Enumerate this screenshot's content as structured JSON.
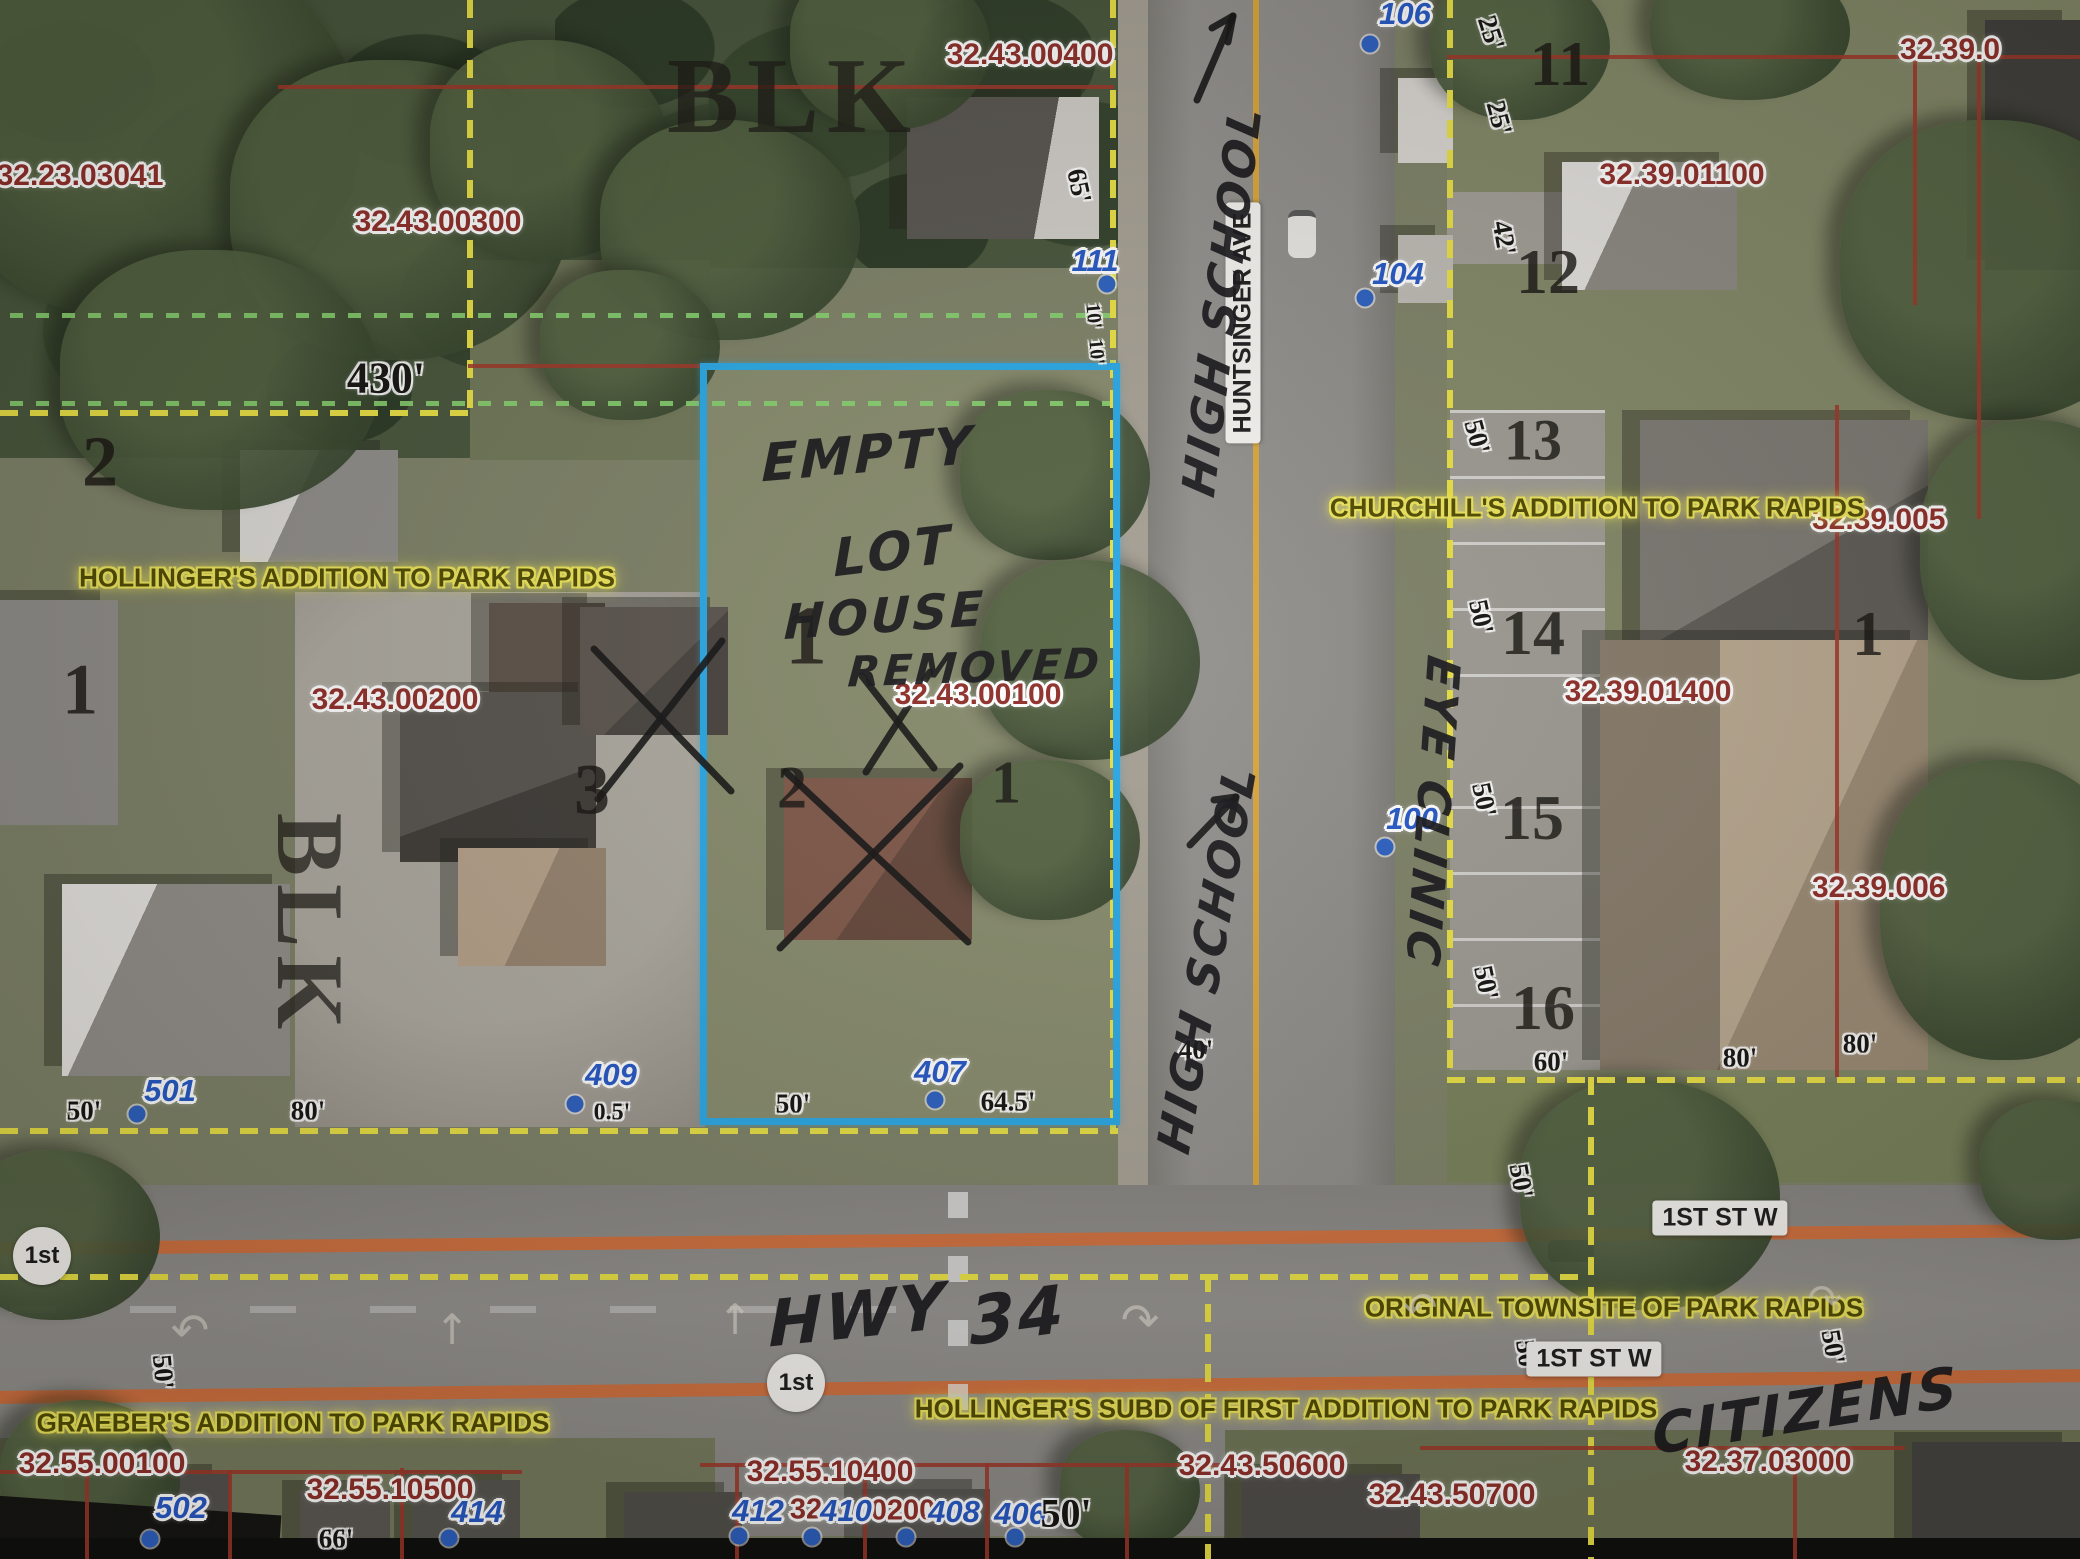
{
  "canvas": {
    "w": 2080,
    "h": 1559
  },
  "colors": {
    "highlight_blue": "#28a7e4",
    "parcel_red": "#8f2d28",
    "house_blue": "#2457c5",
    "boundary_yellow": "#e9e043",
    "setback_green": "#86d36e",
    "section_red": "#9e3527",
    "road_edge_orange": "#cf6f3e",
    "subdivision_yellow": "#f4ec55"
  },
  "highlight_box": {
    "x": 700,
    "y": 363,
    "w": 420,
    "h": 762
  },
  "labels": [
    {
      "t": "parcel",
      "s": "32.23.03041",
      "x": 80,
      "y": 176
    },
    {
      "t": "parcel",
      "s": "32.43.00300",
      "x": 438,
      "y": 222
    },
    {
      "t": "parcel",
      "s": "32.43.00400",
      "x": 1030,
      "y": 55
    },
    {
      "t": "parcel",
      "s": "32.43.00200",
      "x": 395,
      "y": 700
    },
    {
      "t": "parcel",
      "s": "32.43.00100",
      "x": 978,
      "y": 695
    },
    {
      "t": "parcel",
      "s": "32.39.01100",
      "x": 1682,
      "y": 175
    },
    {
      "t": "parcel",
      "s": "32.39.0",
      "x": 1900,
      "y": 50,
      "a": "l"
    },
    {
      "t": "parcel",
      "s": "32.39.005",
      "x": 1812,
      "y": 520,
      "a": "l"
    },
    {
      "t": "parcel",
      "s": "32.39.006",
      "x": 1812,
      "y": 888,
      "a": "l"
    },
    {
      "t": "parcel",
      "s": "32.39.01400",
      "x": 1648,
      "y": 692
    },
    {
      "t": "parcel",
      "s": "32.55.00100",
      "x": 102,
      "y": 1464
    },
    {
      "t": "parcel",
      "s": "32.55.10400",
      "x": 830,
      "y": 1472
    },
    {
      "t": "parcel",
      "s": "32.55.10500",
      "x": 390,
      "y": 1490
    },
    {
      "t": "parcel",
      "s": "32.43.50600",
      "x": 1262,
      "y": 1466
    },
    {
      "t": "parcel",
      "s": "32.43.50700",
      "x": 1452,
      "y": 1495
    },
    {
      "t": "parcel",
      "s": "32.37.03000",
      "x": 1768,
      "y": 1462
    },
    {
      "t": "parcel",
      "s": "32",
      "x": 806,
      "y": 1510,
      "z": 29
    },
    {
      "t": "parcel",
      "s": "0200",
      "x": 903,
      "y": 1511,
      "z": 29
    },
    {
      "t": "house",
      "s": "111",
      "x": 1095,
      "y": 261
    },
    {
      "t": "house",
      "s": "106",
      "x": 1405,
      "y": 14
    },
    {
      "t": "house",
      "s": "104",
      "x": 1398,
      "y": 274
    },
    {
      "t": "house",
      "s": "100",
      "x": 1412,
      "y": 819
    },
    {
      "t": "house",
      "s": "501",
      "x": 170,
      "y": 1091
    },
    {
      "t": "house",
      "s": "409",
      "x": 611,
      "y": 1075
    },
    {
      "t": "house",
      "s": "407",
      "x": 940,
      "y": 1072
    },
    {
      "t": "house",
      "s": "502",
      "x": 181,
      "y": 1508
    },
    {
      "t": "house",
      "s": "414",
      "x": 477,
      "y": 1512
    },
    {
      "t": "house",
      "s": "412",
      "x": 758,
      "y": 1511
    },
    {
      "t": "house",
      "s": "410",
      "x": 846,
      "y": 1511
    },
    {
      "t": "house",
      "s": "408",
      "x": 954,
      "y": 1512
    },
    {
      "t": "house",
      "s": "406",
      "x": 1020,
      "y": 1514
    },
    {
      "t": "lot",
      "s": "2",
      "x": 100,
      "y": 462,
      "z": 72
    },
    {
      "t": "lot",
      "s": "1",
      "x": 80,
      "y": 690,
      "z": 72
    },
    {
      "t": "lot",
      "s": "3",
      "x": 592,
      "y": 790,
      "z": 72
    },
    {
      "t": "lot",
      "s": "2",
      "x": 792,
      "y": 788,
      "z": 60
    },
    {
      "t": "lot",
      "s": "1",
      "x": 1006,
      "y": 783,
      "z": 60
    },
    {
      "t": "lot",
      "s": "1",
      "x": 806,
      "y": 636,
      "z": 84
    },
    {
      "t": "lot",
      "s": "11",
      "x": 1560,
      "y": 64,
      "z": 64
    },
    {
      "t": "lot",
      "s": "12",
      "x": 1548,
      "y": 272,
      "z": 64
    },
    {
      "t": "lot",
      "s": "13",
      "x": 1533,
      "y": 440,
      "z": 58
    },
    {
      "t": "lot",
      "s": "14",
      "x": 1533,
      "y": 633,
      "z": 64
    },
    {
      "t": "lot",
      "s": "15",
      "x": 1532,
      "y": 818,
      "z": 64
    },
    {
      "t": "lot",
      "s": "16",
      "x": 1543,
      "y": 1008,
      "z": 64
    },
    {
      "t": "lot",
      "s": "1",
      "x": 1868,
      "y": 634,
      "z": 64
    },
    {
      "t": "blk",
      "s": "BLK",
      "x": 793,
      "y": 97,
      "z": 108
    },
    {
      "t": "blk",
      "s": "BLK",
      "x": 310,
      "y": 925,
      "z": 95,
      "r": 90
    },
    {
      "t": "dim",
      "s": "430'",
      "x": 386,
      "y": 378,
      "z": 44
    },
    {
      "t": "dim",
      "s": "65'",
      "x": 1079,
      "y": 186,
      "r": 78
    },
    {
      "t": "dim",
      "s": "25'",
      "x": 1491,
      "y": 33,
      "r": 72
    },
    {
      "t": "dim",
      "s": "25'",
      "x": 1499,
      "y": 118,
      "r": 75
    },
    {
      "t": "dim",
      "s": "42'",
      "x": 1504,
      "y": 238,
      "r": 80
    },
    {
      "t": "dim",
      "s": "10'",
      "x": 1093,
      "y": 316,
      "r": 85,
      "z": 20
    },
    {
      "t": "dim",
      "s": "10'",
      "x": 1096,
      "y": 352,
      "r": 85,
      "z": 20
    },
    {
      "t": "dim",
      "s": "50'",
      "x": 84,
      "y": 1111
    },
    {
      "t": "dim",
      "s": "80'",
      "x": 308,
      "y": 1111
    },
    {
      "t": "dim",
      "s": "0.5'",
      "x": 612,
      "y": 1113,
      "z": 24
    },
    {
      "t": "dim",
      "s": "50'",
      "x": 793,
      "y": 1104
    },
    {
      "t": "dim",
      "s": "64.5'",
      "x": 1008,
      "y": 1102
    },
    {
      "t": "dim",
      "s": "40'",
      "x": 1196,
      "y": 1050
    },
    {
      "t": "dim",
      "s": "50'",
      "x": 1477,
      "y": 437,
      "r": 75
    },
    {
      "t": "dim",
      "s": "50'",
      "x": 1481,
      "y": 617,
      "r": 78
    },
    {
      "t": "dim",
      "s": "50'",
      "x": 1484,
      "y": 800,
      "r": 78
    },
    {
      "t": "dim",
      "s": "50'",
      "x": 1486,
      "y": 983,
      "r": 78
    },
    {
      "t": "dim",
      "s": "60'",
      "x": 1551,
      "y": 1062
    },
    {
      "t": "dim",
      "s": "80'",
      "x": 1740,
      "y": 1058
    },
    {
      "t": "dim",
      "s": "80'",
      "x": 1860,
      "y": 1044
    },
    {
      "t": "dim",
      "s": "50'",
      "x": 163,
      "y": 1372,
      "r": 85
    },
    {
      "t": "dim",
      "s": "50'",
      "x": 1521,
      "y": 1181,
      "r": 80
    },
    {
      "t": "dim",
      "s": "50'",
      "x": 1527,
      "y": 1357,
      "r": 82
    },
    {
      "t": "dim",
      "s": "50'",
      "x": 1833,
      "y": 1347,
      "r": 80
    },
    {
      "t": "dim",
      "s": "66'",
      "x": 336,
      "y": 1539
    },
    {
      "t": "dim",
      "s": "50'",
      "x": 1066,
      "y": 1513,
      "z": 40
    },
    {
      "t": "sub",
      "s": "HOLLINGER'S ADDITION TO PARK RAPIDS",
      "x": 347,
      "y": 578
    },
    {
      "t": "sub",
      "s": "CHURCHILL'S ADDITION TO PARK RAPIDS",
      "x": 1597,
      "y": 508
    },
    {
      "t": "sub",
      "s": "ORIGINAL TOWNSITE OF PARK RAPIDS",
      "x": 1614,
      "y": 1308
    },
    {
      "t": "sub",
      "s": "GRAEBER'S ADDITION TO PARK RAPIDS",
      "x": 293,
      "y": 1423
    },
    {
      "t": "sub",
      "s": "HOLLINGER'S SUBD OF FIRST ADDITION TO PARK RAPIDS",
      "x": 1286,
      "y": 1409
    },
    {
      "t": "street",
      "s": "1ST ST W",
      "x": 1720,
      "y": 1218
    },
    {
      "t": "street",
      "s": "1ST ST W",
      "x": 1594,
      "y": 1359
    },
    {
      "t": "street",
      "s": "HUNTSINGER AVE",
      "x": 1243,
      "y": 323,
      "r": -90
    },
    {
      "t": "shield",
      "s": "1st",
      "x": 42,
      "y": 1256
    },
    {
      "t": "shield",
      "s": "1st",
      "x": 796,
      "y": 1383
    },
    {
      "t": "hand",
      "s": "EMPTY",
      "x": 868,
      "y": 455,
      "z": 52,
      "r": -5
    },
    {
      "t": "hand",
      "s": "LOT",
      "x": 893,
      "y": 552,
      "z": 52,
      "r": -7
    },
    {
      "t": "hand",
      "s": "HOUSE",
      "x": 885,
      "y": 616,
      "z": 48,
      "r": -4
    },
    {
      "t": "hand",
      "s": "REMOVED",
      "x": 975,
      "y": 668,
      "z": 42,
      "r": -2
    },
    {
      "t": "hand",
      "s": "HIGH SCHOOL",
      "x": 1222,
      "y": 300,
      "z": 46,
      "r": -83
    },
    {
      "t": "hand",
      "s": "HIGH SCHOOL",
      "x": 1207,
      "y": 958,
      "z": 46,
      "r": -80
    },
    {
      "t": "hand",
      "s": "EYE CLINIC",
      "x": 1433,
      "y": 812,
      "z": 46,
      "r": 94
    },
    {
      "t": "hand",
      "s": "HWY",
      "x": 858,
      "y": 1316,
      "z": 64,
      "r": -6
    },
    {
      "t": "hand",
      "s": "34",
      "x": 1018,
      "y": 1316,
      "z": 66,
      "r": -8
    },
    {
      "t": "hand",
      "s": "CITIZENS",
      "x": 1806,
      "y": 1412,
      "z": 56,
      "r": -9
    },
    {
      "t": "rarrow",
      "s": "↶",
      "x": 190,
      "y": 1330,
      "z": 46
    },
    {
      "t": "rarrow",
      "s": "↑",
      "x": 452,
      "y": 1330,
      "z": 42
    },
    {
      "t": "rarrow",
      "s": "↑",
      "x": 735,
      "y": 1320,
      "z": 42
    },
    {
      "t": "rarrow",
      "s": "↷",
      "x": 1140,
      "y": 1320,
      "z": 46
    },
    {
      "t": "rarrow",
      "s": "↶",
      "x": 1420,
      "y": 1308,
      "z": 42
    },
    {
      "t": "rarrow",
      "s": "↷",
      "x": 1825,
      "y": 1300,
      "z": 42
    }
  ],
  "dots": [
    {
      "x": 1107,
      "y": 284
    },
    {
      "x": 1370,
      "y": 44
    },
    {
      "x": 1365,
      "y": 298
    },
    {
      "x": 1385,
      "y": 847
    },
    {
      "x": 137,
      "y": 1114
    },
    {
      "x": 575,
      "y": 1104
    },
    {
      "x": 935,
      "y": 1100
    },
    {
      "x": 150,
      "y": 1539
    },
    {
      "x": 449,
      "y": 1538
    },
    {
      "x": 739,
      "y": 1536
    },
    {
      "x": 812,
      "y": 1537
    },
    {
      "x": 906,
      "y": 1537
    },
    {
      "x": 1015,
      "y": 1537
    }
  ],
  "lines": [
    {
      "k": "y",
      "o": "v",
      "x": 467,
      "y": 0,
      "len": 412
    },
    {
      "k": "y",
      "o": "h",
      "x": 0,
      "y": 410,
      "len": 472
    },
    {
      "k": "y",
      "o": "v",
      "x": 1110,
      "y": 0,
      "len": 1132
    },
    {
      "k": "y",
      "o": "h",
      "x": 0,
      "y": 1128,
      "len": 1118
    },
    {
      "k": "y",
      "o": "v",
      "x": 1447,
      "y": 0,
      "len": 1080
    },
    {
      "k": "y",
      "o": "h",
      "x": 1447,
      "y": 1077,
      "len": 633
    },
    {
      "k": "y",
      "o": "v",
      "x": 1588,
      "y": 1077,
      "len": 482
    },
    {
      "k": "y",
      "o": "h",
      "x": 0,
      "y": 1274,
      "len": 1588
    },
    {
      "k": "y",
      "o": "v",
      "x": 1205,
      "y": 1274,
      "len": 285
    },
    {
      "k": "g",
      "o": "h",
      "x": 10,
      "y": 313,
      "len": 1100
    },
    {
      "k": "g",
      "o": "h",
      "x": 10,
      "y": 401,
      "len": 1100
    },
    {
      "k": "r",
      "o": "h",
      "x": 278,
      "y": 85,
      "len": 836
    },
    {
      "k": "r",
      "o": "h",
      "x": 1447,
      "y": 55,
      "len": 633
    },
    {
      "k": "r",
      "o": "h",
      "x": 468,
      "y": 364,
      "len": 234
    },
    {
      "k": "r",
      "o": "v",
      "x": 1913,
      "y": 55,
      "len": 250
    },
    {
      "k": "r",
      "o": "v",
      "x": 1977,
      "y": 57,
      "len": 462
    },
    {
      "k": "r",
      "o": "v",
      "x": 1835,
      "y": 405,
      "len": 672
    },
    {
      "k": "r",
      "o": "h",
      "x": 0,
      "y": 1470,
      "len": 522
    },
    {
      "k": "r",
      "o": "v",
      "x": 85,
      "y": 1470,
      "len": 89
    },
    {
      "k": "r",
      "o": "v",
      "x": 228,
      "y": 1470,
      "len": 89
    },
    {
      "k": "r",
      "o": "v",
      "x": 400,
      "y": 1468,
      "len": 91
    },
    {
      "k": "r",
      "o": "h",
      "x": 700,
      "y": 1463,
      "len": 520
    },
    {
      "k": "r",
      "o": "v",
      "x": 735,
      "y": 1463,
      "len": 96
    },
    {
      "k": "r",
      "o": "v",
      "x": 863,
      "y": 1463,
      "len": 96
    },
    {
      "k": "r",
      "o": "v",
      "x": 985,
      "y": 1463,
      "len": 96
    },
    {
      "k": "r",
      "o": "v",
      "x": 1125,
      "y": 1463,
      "len": 96
    },
    {
      "k": "r",
      "o": "h",
      "x": 1420,
      "y": 1446,
      "len": 485
    },
    {
      "k": "r",
      "o": "v",
      "x": 1793,
      "y": 1446,
      "len": 113
    }
  ],
  "ink": [
    [
      [
        1197,
        100
      ],
      [
        1233,
        16
      ]
    ],
    [
      [
        1233,
        16
      ],
      [
        1212,
        28
      ]
    ],
    [
      [
        1233,
        16
      ],
      [
        1228,
        42
      ]
    ],
    [
      [
        1190,
        845
      ],
      [
        1236,
        797
      ]
    ],
    [
      [
        1236,
        797
      ],
      [
        1214,
        800
      ]
    ],
    [
      [
        1236,
        797
      ],
      [
        1231,
        820
      ]
    ],
    [
      [
        594,
        649
      ],
      [
        731,
        791
      ]
    ],
    [
      [
        722,
        641
      ],
      [
        598,
        799
      ]
    ],
    [
      [
        862,
        676
      ],
      [
        934,
        768
      ]
    ],
    [
      [
        930,
        672
      ],
      [
        866,
        772
      ]
    ],
    [
      [
        786,
        772
      ],
      [
        968,
        942
      ]
    ],
    [
      [
        960,
        766
      ],
      [
        780,
        948
      ]
    ]
  ]
}
